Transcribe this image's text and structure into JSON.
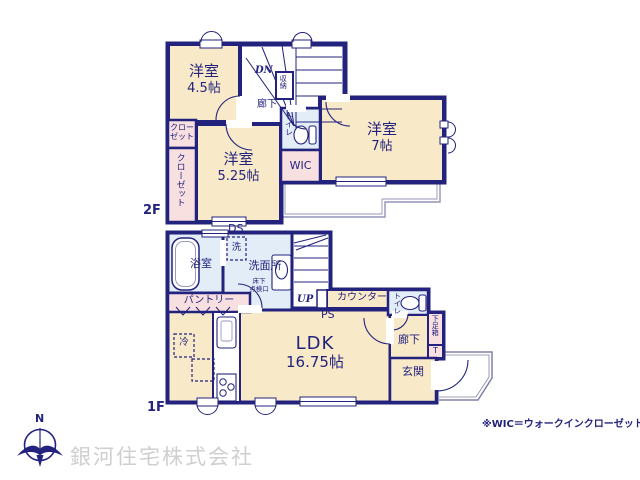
{
  "window_note": "※WIC＝ウォークインクローゼット",
  "watermark": "銀河住宅株式会社",
  "compass": {
    "north": "N"
  },
  "colors": {
    "wall": "#23237e",
    "room_fill": "#f8e9c8",
    "closet_fill": "#f8dfe0",
    "wet_fill": "#e3edf7",
    "watermark": "#cfcfcf"
  },
  "floor2": {
    "label": "2F",
    "rooms": {
      "youshitsu45": {
        "name": "洋室",
        "size": "4.5帖"
      },
      "youshitsu7": {
        "name": "洋室",
        "size": "7帖"
      },
      "youshitsu525": {
        "name": "洋室",
        "size": "5.25帖"
      }
    },
    "closet_top": {
      "line1": "クロー",
      "line2": "ゼット"
    },
    "closet_side": "クローゼット",
    "wic": "WIC",
    "toilet": "トイレ",
    "storage": "収納",
    "hallway": "廊下",
    "stairs": "DN",
    "ds": "DS"
  },
  "floor1": {
    "label": "1F",
    "bath": "浴室",
    "washer": "洗",
    "washroom": "洗面所",
    "hatch": {
      "line1": "床下",
      "line2": "点検口"
    },
    "stairs": "UP",
    "pantry": "パントリー",
    "counter": "カウンター",
    "ps": "PS",
    "ldk": {
      "name": "LDK",
      "size": "16.75帖"
    },
    "fridge": "冷",
    "toilet": "トイレ",
    "hallway": "廊下",
    "shoebox": "下足箱",
    "shoebox_t": "T",
    "entrance": "玄関"
  }
}
